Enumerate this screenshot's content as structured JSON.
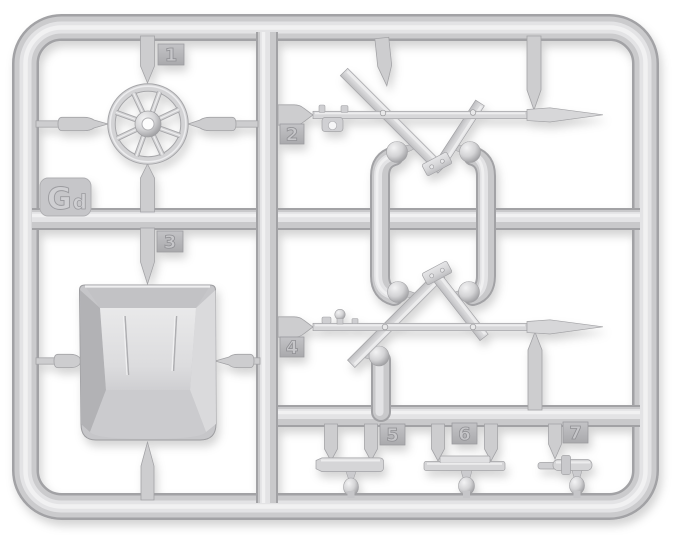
{
  "sprue": {
    "description": "Light gray injection-molded plastic model-kit sprue (parts tree) photographed on a white background, with seven numbered attachment tags and a sprue code tab",
    "code_label": {
      "main": "G",
      "sub": "d"
    },
    "tags": [
      {
        "number": "1"
      },
      {
        "number": "2"
      },
      {
        "number": "3"
      },
      {
        "number": "4"
      },
      {
        "number": "5"
      },
      {
        "number": "6"
      },
      {
        "number": "7"
      }
    ],
    "parts": [
      {
        "tag": "1",
        "name": "eight-spoke wheel"
      },
      {
        "tag": "2",
        "name": "long rod with folding scissor support legs"
      },
      {
        "tag": "3",
        "name": "open trapezoid box / bucket"
      },
      {
        "tag": "4",
        "name": "long rod with folding scissor support legs (mirrored)"
      },
      {
        "tag": "5",
        "name": "small chamfered beam"
      },
      {
        "tag": "6",
        "name": "small beam with flat plate"
      },
      {
        "tag": "7",
        "name": "small cylindrical fitting with collar"
      }
    ],
    "colors": {
      "background": "#ffffff",
      "plastic_base": "#d2d2d4",
      "plastic_highlight": "#f0f0f1",
      "plastic_shadow": "#a4a4a7",
      "tag_plate": "#b7b7ba"
    }
  }
}
